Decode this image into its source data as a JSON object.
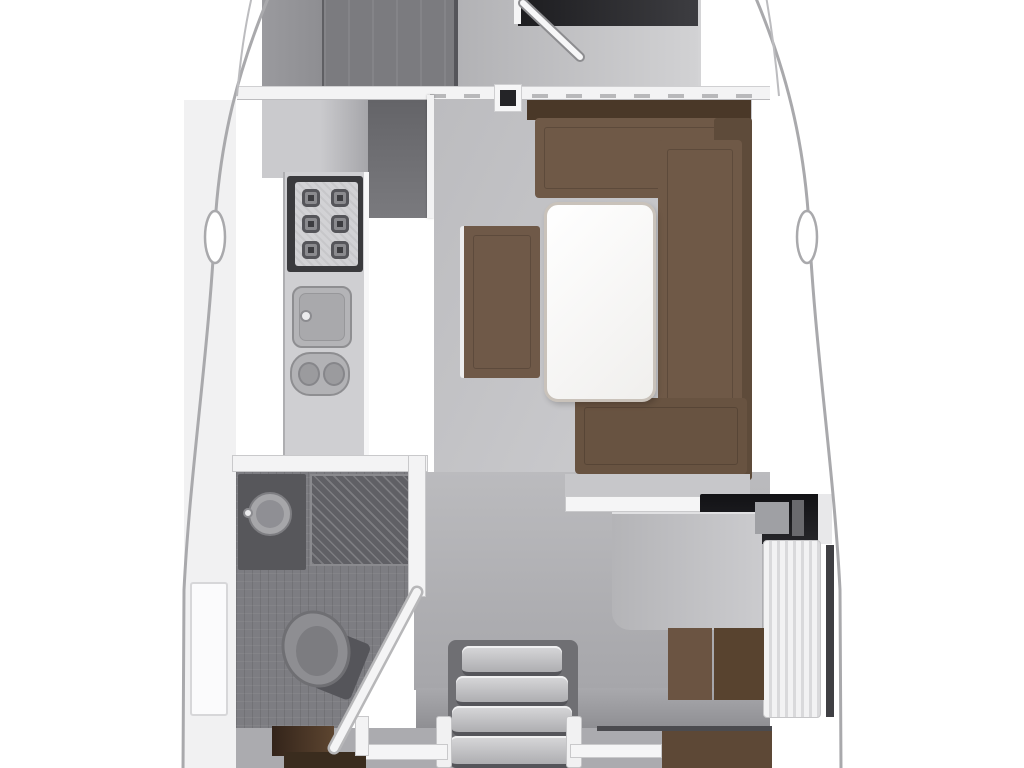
{
  "meta": {
    "title": "Sailing yacht interior floor plan — saloon deck (top-down view)",
    "diagram_type": "floor-plan",
    "text_visible": "none"
  },
  "palette": {
    "background": "#ffffff",
    "hull_outline": "#a9a9ac",
    "bulkhead_white": "#f3f3f4",
    "floor_light": "#c9c9cc",
    "floor_mid": "#b1b1b5",
    "floor_dark_head": "#7d7d82",
    "cabinet_gray": "#7b7b7f",
    "stainless_counter": "#cfcfd2",
    "stove_black": "#3a3a3d",
    "settee_brown": "#6f5947",
    "settee_shelf_brown": "#4a3828",
    "aft_berth_brown": "#5d4836",
    "head_door_brown": "#33241a",
    "table_white": "#fafafa",
    "instrument_panel_black": "#1a1a1d",
    "forward_berth_black": "#1d1d20"
  },
  "rooms": [
    {
      "id": "forward-cabin",
      "label": "forward cabin (door ajar, berth visible)"
    },
    {
      "id": "galley",
      "label": "galley: stove, sink, double sink, counters"
    },
    {
      "id": "saloon",
      "label": "saloon: U-shaped settee, dining table, bench"
    },
    {
      "id": "head",
      "label": "head: washbasin, shower grate, toilet, angled partition"
    },
    {
      "id": "nav-station",
      "label": "navigation station: chart table, instrument panel, slatted seat"
    },
    {
      "id": "companionway",
      "label": "companionway stairs with handrails"
    },
    {
      "id": "aft-cabin-port",
      "label": "aft cabin entry, port side"
    },
    {
      "id": "aft-cabin-starboard",
      "label": "aft cabin entry, starboard side"
    }
  ],
  "furniture_icons": [
    "stove-icon",
    "sink-icon",
    "double-sink-icon",
    "dining-table-icon",
    "settee-icon",
    "bench-icon",
    "washbasin-icon",
    "toilet-icon",
    "shower-grate-icon",
    "stairs-icon",
    "chart-table-icon",
    "instrument-panel-icon",
    "door-hinge-icon",
    "cleat-icon"
  ]
}
